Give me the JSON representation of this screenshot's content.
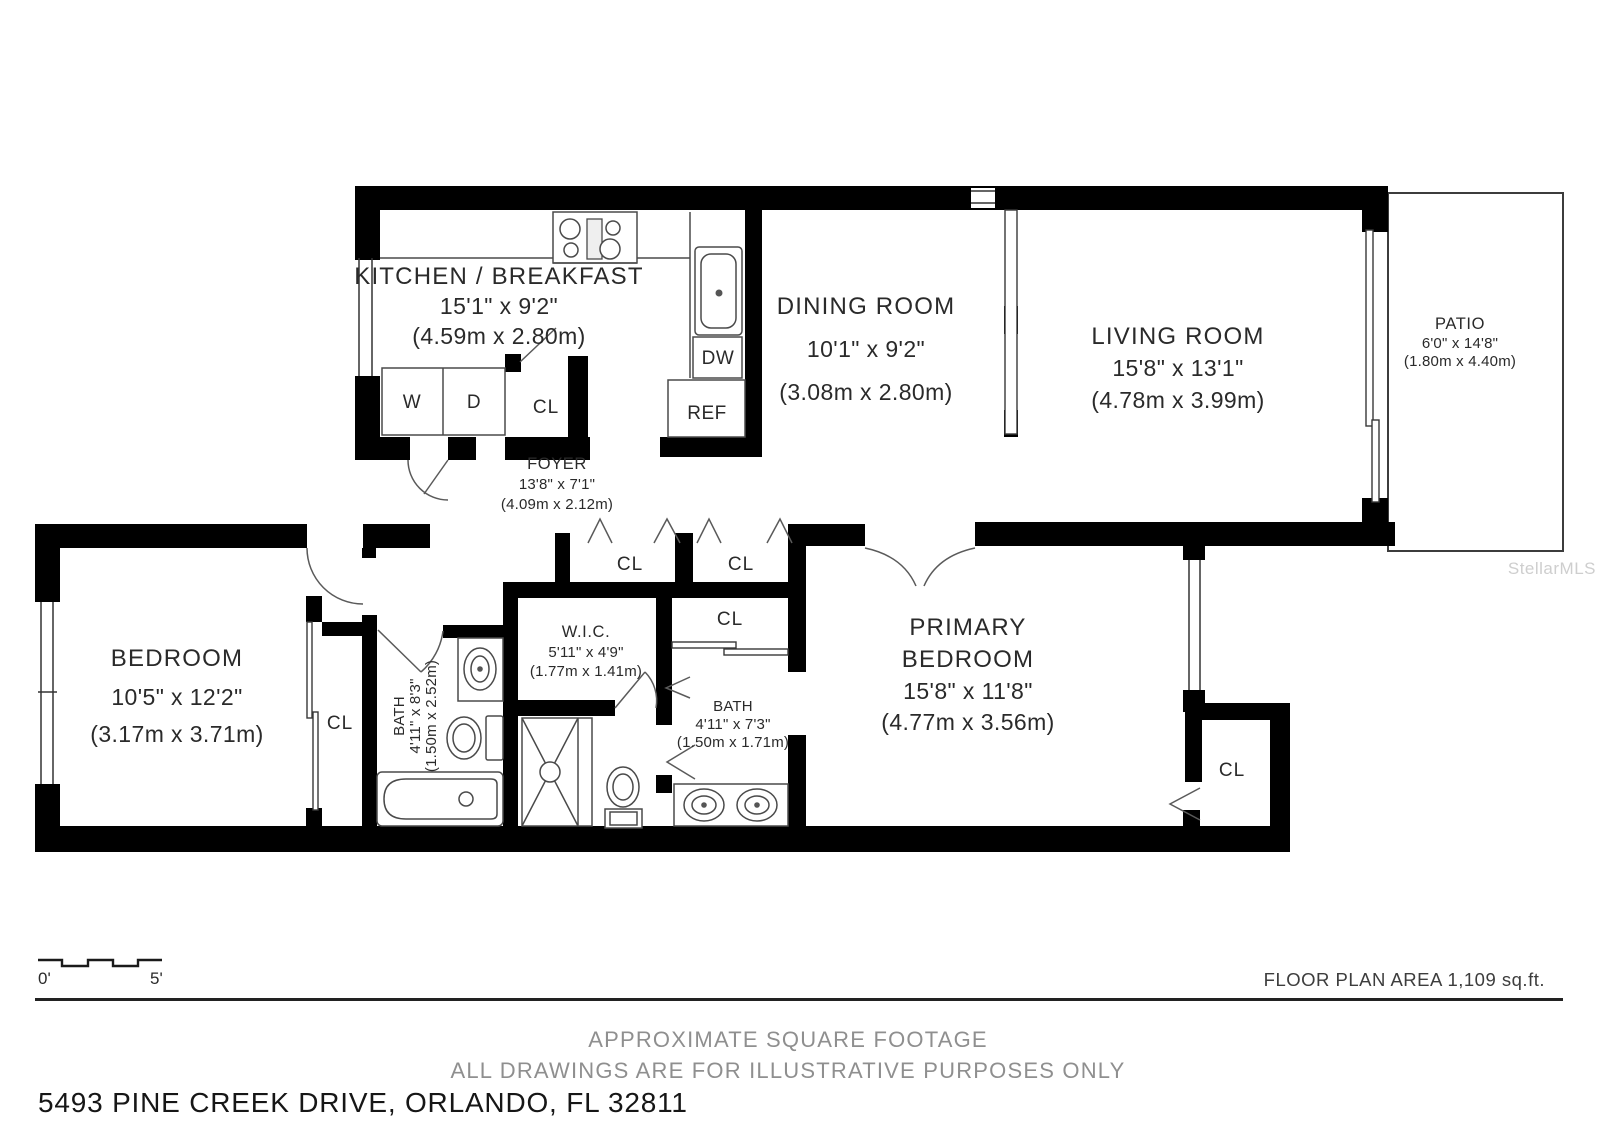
{
  "labels": {
    "closet": "CL",
    "washer": "W",
    "dryer": "D",
    "dishwasher": "DW",
    "refrigerator": "REF"
  },
  "rooms": {
    "kitchen": {
      "name": "KITCHEN / BREAKFAST",
      "imperial": "15'1\" x 9'2\"",
      "metric": "(4.59m x 2.80m)"
    },
    "dining": {
      "name": "DINING ROOM",
      "imperial": "10'1\" x 9'2\"",
      "metric": "(3.08m x 2.80m)"
    },
    "living": {
      "name": "LIVING ROOM",
      "imperial": "15'8\" x 13'1\"",
      "metric": "(4.78m x 3.99m)"
    },
    "patio": {
      "name": "PATIO",
      "imperial": "6'0\" x 14'8\"",
      "metric": "(1.80m x 4.40m)"
    },
    "foyer": {
      "name": "FOYER",
      "imperial": "13'8\" x 7'1\"",
      "metric": "(4.09m x 2.12m)"
    },
    "bedroom": {
      "name": "BEDROOM",
      "imperial": "10'5\" x 12'2\"",
      "metric": "(3.17m x 3.71m)"
    },
    "bath1": {
      "name": "BATH",
      "imperial": "4'11\" x 8'3\"",
      "metric": "(1.50m x 2.52m)"
    },
    "wic": {
      "name": "W.I.C.",
      "imperial": "5'11\" x 4'9\"",
      "metric": "(1.77m x 1.41m)"
    },
    "bath2": {
      "name": "BATH",
      "imperial": "4'11\" x 7'3\"",
      "metric": "(1.50m x 1.71m)"
    },
    "primary": {
      "name_line1": "PRIMARY",
      "name_line2": "BEDROOM",
      "imperial": "15'8\" x 11'8\"",
      "metric": "(4.77m x 3.56m)"
    }
  },
  "scale_bar": {
    "start": "0'",
    "end": "5'"
  },
  "footer": {
    "area_note": "FLOOR PLAN AREA 1,109 sq.ft.",
    "disclaimer_line1": "APPROXIMATE SQUARE FOOTAGE",
    "disclaimer_line2": "ALL DRAWINGS ARE FOR ILLUSTRATIVE PURPOSES ONLY",
    "address": "5493 PINE CREEK DRIVE, ORLANDO, FL 32811"
  },
  "watermark": "StellarMLS"
}
